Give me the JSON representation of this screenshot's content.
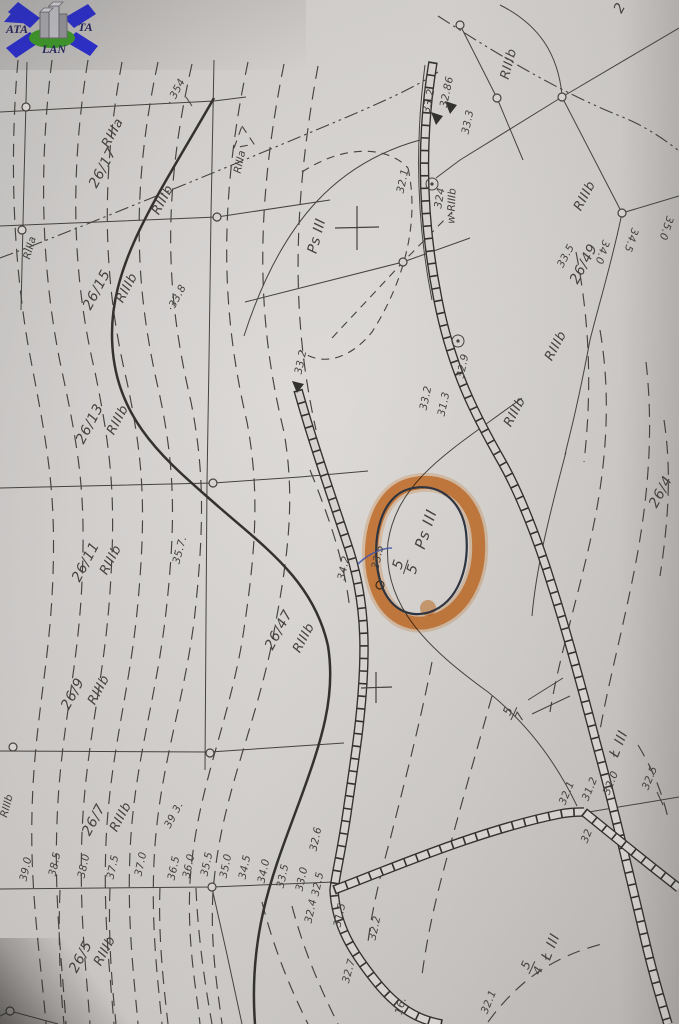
{
  "colors": {
    "paper": "#d5d2cf",
    "ink": "#45433f",
    "ink_dark": "#34322f",
    "highlighter_orange": "#e78f35",
    "pen_dark": "#2e3440",
    "pen_blue": "#4356a8",
    "logo_arrow_blue": "#2b2fd4",
    "logo_ellipse_green": "#3f9e2a",
    "logo_building_gray": "#b9b9bd",
    "logo_text_navy": "#23235e"
  },
  "logo": {
    "text_left": "ATA",
    "text_right": "TA",
    "text_bottom": "LAN"
  },
  "highlight": {
    "label": "Ps III",
    "fraction_top": "5",
    "fraction_bottom": "5"
  },
  "map": {
    "labels": [
      {
        "text": "· 354",
        "x": 176,
        "y": 92,
        "rot": -62,
        "cls": "elev"
      },
      {
        "text": "26/17",
        "x": 103,
        "y": 168,
        "rot": -62,
        "cls": "parcel"
      },
      {
        "text": "RIIIa",
        "x": 113,
        "y": 133,
        "rot": -62,
        "cls": "soil"
      },
      {
        "text": "RIIIb",
        "x": 163,
        "y": 200,
        "rot": -62,
        "cls": "soil"
      },
      {
        "text": "RIIIa",
        "x": 240,
        "y": 162,
        "rot": -78,
        "cls": "soil-sm"
      },
      {
        "text": "RIIIa",
        "x": 30,
        "y": 248,
        "rot": -75,
        "cls": "soil-sm"
      },
      {
        "text": "26/15",
        "x": 97,
        "y": 290,
        "rot": -62,
        "cls": "parcel"
      },
      {
        "text": "RIIIb",
        "x": 127,
        "y": 288,
        "rot": -62,
        "cls": "soil"
      },
      {
        "text": "·33.8",
        "x": 177,
        "y": 298,
        "rot": -62,
        "cls": "elev"
      },
      {
        "text": "26/13",
        "x": 90,
        "y": 424,
        "rot": -62,
        "cls": "parcel"
      },
      {
        "text": "RIIIb",
        "x": 118,
        "y": 420,
        "rot": -62,
        "cls": "soil"
      },
      {
        "text": "26/11",
        "x": 86,
        "y": 562,
        "rot": -62,
        "cls": "parcel"
      },
      {
        "text": "RIIIb",
        "x": 111,
        "y": 560,
        "rot": -62,
        "cls": "soil"
      },
      {
        "text": "35.7.",
        "x": 180,
        "y": 550,
        "rot": -75,
        "cls": "elev"
      },
      {
        "text": "26/9",
        "x": 73,
        "y": 694,
        "rot": -62,
        "cls": "parcel"
      },
      {
        "text": "RIIIb",
        "x": 99,
        "y": 690,
        "rot": -62,
        "cls": "soil"
      },
      {
        "text": "26/7",
        "x": 94,
        "y": 820,
        "rot": -62,
        "cls": "parcel"
      },
      {
        "text": "RIIIb",
        "x": 121,
        "y": 817,
        "rot": -62,
        "cls": "soil"
      },
      {
        "text": "RIIIb",
        "x": 7,
        "y": 806,
        "rot": -75,
        "cls": "soil-sm"
      },
      {
        "text": "26/5",
        "x": 81,
        "y": 957,
        "rot": -62,
        "cls": "parcel"
      },
      {
        "text": "RIIIb",
        "x": 105,
        "y": 951,
        "rot": -62,
        "cls": "soil"
      },
      {
        "text": "26/47",
        "x": 279,
        "y": 630,
        "rot": -62,
        "cls": "parcel"
      },
      {
        "text": "RIIIb",
        "x": 304,
        "y": 638,
        "rot": -62,
        "cls": "soil"
      },
      {
        "text": "Ps III",
        "x": 317,
        "y": 236,
        "rot": -75,
        "cls": "parcel"
      },
      {
        "text": "32.1",
        "x": 403,
        "y": 181,
        "rot": -78,
        "cls": "elev"
      },
      {
        "text": "324",
        "x": 440,
        "y": 198,
        "rot": -80,
        "cls": "elev"
      },
      {
        "text": "w-RIIIb",
        "x": 452,
        "y": 206,
        "rot": -88,
        "cls": "soil-sm"
      },
      {
        "text": "33.2",
        "x": 429,
        "y": 101,
        "rot": -78,
        "cls": "elev"
      },
      {
        "text": "32.86",
        "x": 447,
        "y": 92,
        "rot": -78,
        "cls": "elev"
      },
      {
        "text": "33.3",
        "x": 468,
        "y": 122,
        "rot": -78,
        "cls": "elev"
      },
      {
        "text": "RIIIb",
        "x": 509,
        "y": 64,
        "rot": -75,
        "cls": "soil"
      },
      {
        "text": "2",
        "x": 620,
        "y": 8,
        "rot": -62,
        "cls": "parcel"
      },
      {
        "text": "33.2",
        "x": 301,
        "y": 362,
        "rot": -78,
        "cls": "elev"
      },
      {
        "text": "33.2",
        "x": 426,
        "y": 398,
        "rot": -78,
        "cls": "elev"
      },
      {
        "text": "31.3",
        "x": 444,
        "y": 404,
        "rot": -78,
        "cls": "elev"
      },
      {
        "text": "32.9",
        "x": 463,
        "y": 366,
        "rot": -78,
        "cls": "elev"
      },
      {
        "text": "RIIIb",
        "x": 515,
        "y": 412,
        "rot": -62,
        "cls": "soil"
      },
      {
        "text": "RIIIb",
        "x": 556,
        "y": 346,
        "rot": -62,
        "cls": "soil"
      },
      {
        "text": "RIIIb",
        "x": 585,
        "y": 196,
        "rot": -62,
        "cls": "soil"
      },
      {
        "text": "26/49",
        "x": 584,
        "y": 264,
        "rot": -62,
        "cls": "parcel"
      },
      {
        "text": "33.5",
        "x": 566,
        "y": 256,
        "rot": -62,
        "cls": "elev"
      },
      {
        "text": "34.0",
        "x": 602,
        "y": 252,
        "rot": 108,
        "cls": "elev"
      },
      {
        "text": "34.5",
        "x": 631,
        "y": 240,
        "rot": 108,
        "cls": "elev"
      },
      {
        "text": "35.0",
        "x": 666,
        "y": 228,
        "rot": 108,
        "cls": "elev"
      },
      {
        "text": "26/4",
        "x": 661,
        "y": 492,
        "rot": -62,
        "cls": "parcel"
      },
      {
        "text": "34.2",
        "x": 344,
        "y": 568,
        "rot": -78,
        "cls": "elev"
      },
      {
        "text": "33.5",
        "x": 378,
        "y": 557,
        "rot": -78,
        "cls": "elev"
      },
      {
        "text": "Ps III",
        "x": 426,
        "y": 529,
        "rot": -72,
        "cls": "parcel-lg"
      },
      {
        "text": "39.0",
        "x": 26,
        "y": 869,
        "rot": -78,
        "cls": "elev"
      },
      {
        "text": "38.5",
        "x": 55,
        "y": 864,
        "rot": -78,
        "cls": "elev"
      },
      {
        "text": "38.0",
        "x": 84,
        "y": 866,
        "rot": -78,
        "cls": "elev"
      },
      {
        "text": "37.5",
        "x": 113,
        "y": 867,
        "rot": -78,
        "cls": "elev"
      },
      {
        "text": "37.0",
        "x": 141,
        "y": 864,
        "rot": -78,
        "cls": "elev"
      },
      {
        "text": "36.5",
        "x": 174,
        "y": 868,
        "rot": -78,
        "cls": "elev"
      },
      {
        "text": "36.0",
        "x": 189,
        "y": 866,
        "rot": -78,
        "cls": "elev"
      },
      {
        "text": "35.5",
        "x": 207,
        "y": 864,
        "rot": -78,
        "cls": "elev"
      },
      {
        "text": "39 3.",
        "x": 174,
        "y": 815,
        "rot": -62,
        "cls": "elev"
      },
      {
        "text": "35.0",
        "x": 226,
        "y": 866,
        "rot": -78,
        "cls": "elev"
      },
      {
        "text": "34.5",
        "x": 245,
        "y": 867,
        "rot": -78,
        "cls": "elev"
      },
      {
        "text": "34.0",
        "x": 264,
        "y": 871,
        "rot": -78,
        "cls": "elev"
      },
      {
        "text": "33.5",
        "x": 283,
        "y": 876,
        "rot": -78,
        "cls": "elev"
      },
      {
        "text": "33.0",
        "x": 302,
        "y": 879,
        "rot": -78,
        "cls": "elev"
      },
      {
        "text": "32.5",
        "x": 318,
        "y": 884,
        "rot": -78,
        "cls": "elev"
      },
      {
        "text": "32.6",
        "x": 316,
        "y": 839,
        "rot": -78,
        "cls": "elev"
      },
      {
        "text": "32.4",
        "x": 311,
        "y": 911,
        "rot": -78,
        "cls": "elev"
      },
      {
        "text": "31.5",
        "x": 340,
        "y": 915,
        "rot": -78,
        "cls": "elev"
      },
      {
        "text": "32.2",
        "x": 375,
        "y": 928,
        "rot": -78,
        "cls": "elev"
      },
      {
        "text": "Ł III",
        "x": 619,
        "y": 744,
        "rot": -68,
        "cls": "parcel"
      },
      {
        "text": "32.5",
        "x": 650,
        "y": 778,
        "rot": -68,
        "cls": "elev"
      },
      {
        "text": "32.1",
        "x": 567,
        "y": 793,
        "rot": -68,
        "cls": "elev"
      },
      {
        "text": "31.2",
        "x": 590,
        "y": 789,
        "rot": -68,
        "cls": "elev"
      },
      {
        "text": "32.0",
        "x": 611,
        "y": 783,
        "rot": -68,
        "cls": "elev"
      },
      {
        "text": "32",
        "x": 587,
        "y": 836,
        "rot": -68,
        "cls": "elev"
      },
      {
        "text": "Ł III",
        "x": 551,
        "y": 947,
        "rot": -68,
        "cls": "parcel"
      },
      {
        "text": "32.1",
        "x": 489,
        "y": 1002,
        "rot": -68,
        "cls": "elev"
      },
      {
        "text": "16.",
        "x": 401,
        "y": 1006,
        "rot": -75,
        "cls": "elev"
      },
      {
        "text": "32.7",
        "x": 349,
        "y": 971,
        "rot": -75,
        "cls": "elev"
      }
    ],
    "fractions": [
      {
        "top": "5",
        "bottom": "5",
        "x": 406,
        "y": 567,
        "rot": -72,
        "cls": "lg"
      },
      {
        "top": "5",
        "bottom": "7",
        "x": 514,
        "y": 714,
        "rot": -65,
        "cls": "md"
      },
      {
        "top": "5",
        "bottom": "4",
        "x": 532,
        "y": 968,
        "rot": -65,
        "cls": "md"
      }
    ]
  }
}
